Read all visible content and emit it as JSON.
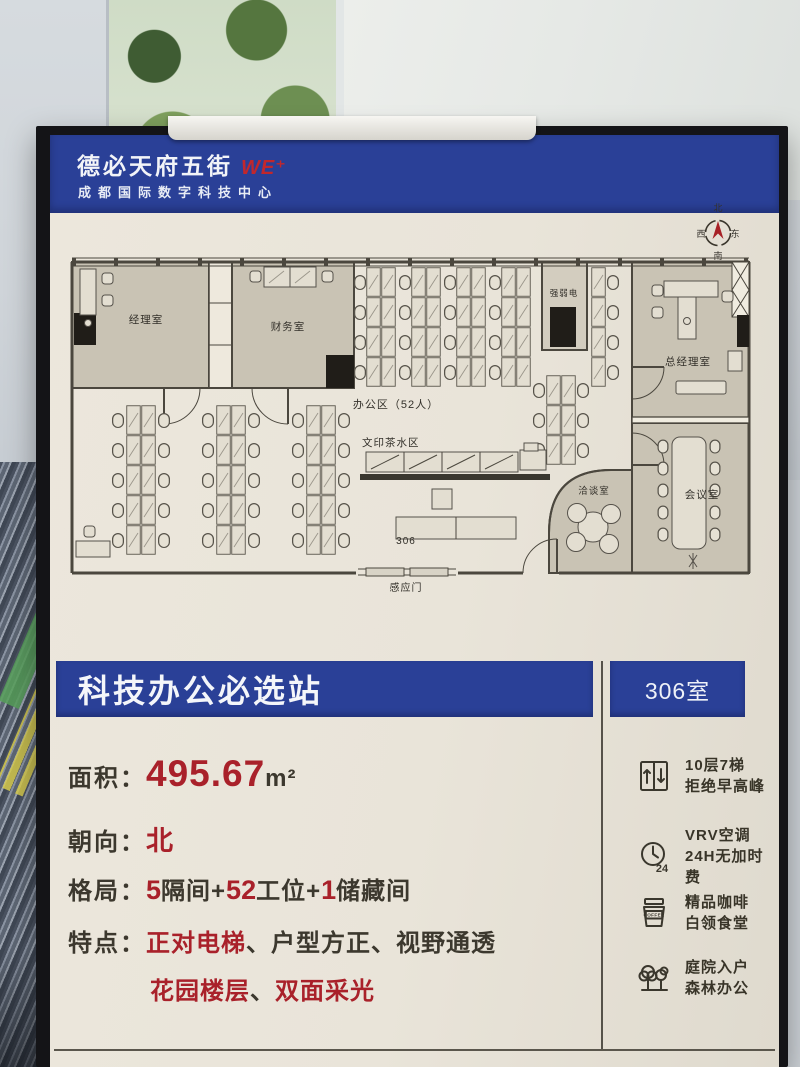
{
  "colors": {
    "brand_blue": "#2a4097",
    "accent_red": "#a9212a",
    "poster_cream": "#eae5da",
    "ink": "#3b372c",
    "room_tan": "#c9c3b4"
  },
  "header": {
    "brand": "德必天府五街",
    "brand_mark": "WE⁺",
    "subtitle": "成都国际数字科技中心"
  },
  "floor_plan": {
    "compass": {
      "north": "北",
      "south": "南",
      "east": "东",
      "west": "西"
    },
    "labels": {
      "manager_office": "经理室",
      "finance_office": "财务室",
      "office_area": "办公区（52人）",
      "print_tea_area": "文印茶水区",
      "electrical_room": "强弱电",
      "gm_office": "总经理室",
      "negotiation_room": "洽谈室",
      "meeting_room": "会议室",
      "room_number": "306",
      "sensor_door": "感应门"
    }
  },
  "banner": {
    "title": "科技办公必选站",
    "room_no": "306室"
  },
  "details": {
    "area": {
      "label": "面积：",
      "value": "495.67",
      "unit": "m²"
    },
    "facing": {
      "label": "朝向：",
      "value": "北"
    },
    "layout": {
      "label": "格局：",
      "seg1": "5",
      "seg2": "隔间+",
      "seg3": "52",
      "seg4": "工位+",
      "seg5": "1",
      "seg6": "储藏间"
    },
    "features": {
      "label": "特点：",
      "seg1": "正对电梯",
      "seg2": "、户型方正、视野通透",
      "seg3": "花园楼层",
      "seg4": "、",
      "seg5": "双面采光"
    }
  },
  "amenities": [
    {
      "icon": "elevator-icon",
      "line1": "10层7梯",
      "line2": "拒绝早高峰"
    },
    {
      "icon": "clock-24h-icon",
      "icon_label": "24",
      "line1": "VRV空调",
      "line2": "24H无加时费"
    },
    {
      "icon": "coffee-cup-icon",
      "icon_label": "COFFEE",
      "line1": "精品咖啡",
      "line2": "白领食堂"
    },
    {
      "icon": "trees-icon",
      "line1": "庭院入户",
      "line2": "森林办公"
    }
  ]
}
